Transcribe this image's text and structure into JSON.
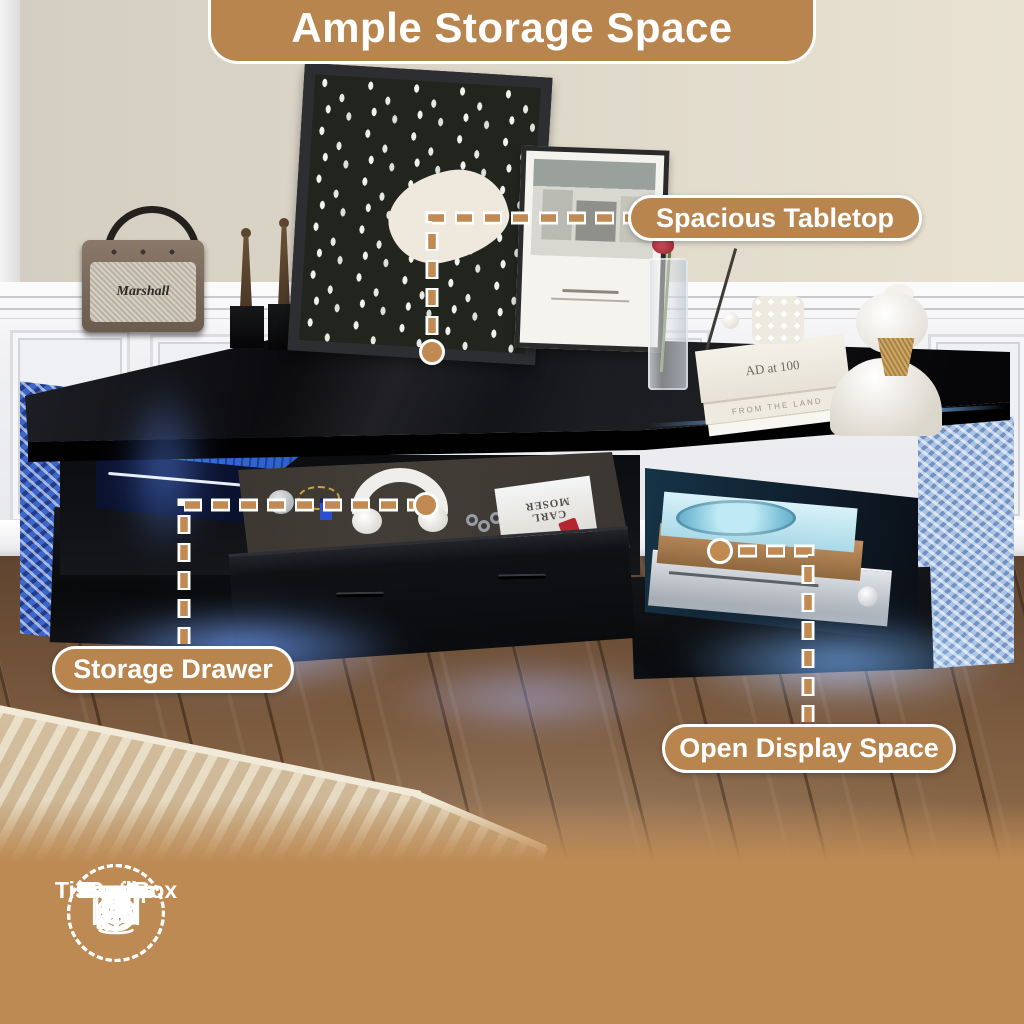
{
  "banner": {
    "title": "Ample Storage Space"
  },
  "callouts": [
    {
      "id": "spacious-tabletop",
      "label": "Spacious Tabletop"
    },
    {
      "id": "storage-drawer",
      "label": "Storage Drawer"
    },
    {
      "id": "open-display-space",
      "label": "Open Display Space"
    }
  ],
  "legend": {
    "items": [
      {
        "icon": "laptop-icon",
        "label": "Laptop"
      },
      {
        "icon": "cups-icon",
        "label": "Cups"
      },
      {
        "icon": "tissue-box-icon",
        "label": "Tissue Box"
      },
      {
        "icon": "books-icon",
        "label": "Books"
      },
      {
        "icon": "fruits-icon",
        "label": "Fruits"
      },
      {
        "icon": "snacks-icon",
        "label": "Snacks"
      }
    ]
  },
  "scene": {
    "speaker_brand": "Marshall",
    "book_stack_top": "AD at 100",
    "book_stack_spine": "FROM THE LAND",
    "drawer_book_title": "CARL MOSER"
  },
  "colors": {
    "accent_brown": "#b8854f",
    "band_brown": "#bd8a54",
    "dash_tan": "#c08a52",
    "outline_white": "#ffffff",
    "led_blue": "#4f7fe8"
  }
}
